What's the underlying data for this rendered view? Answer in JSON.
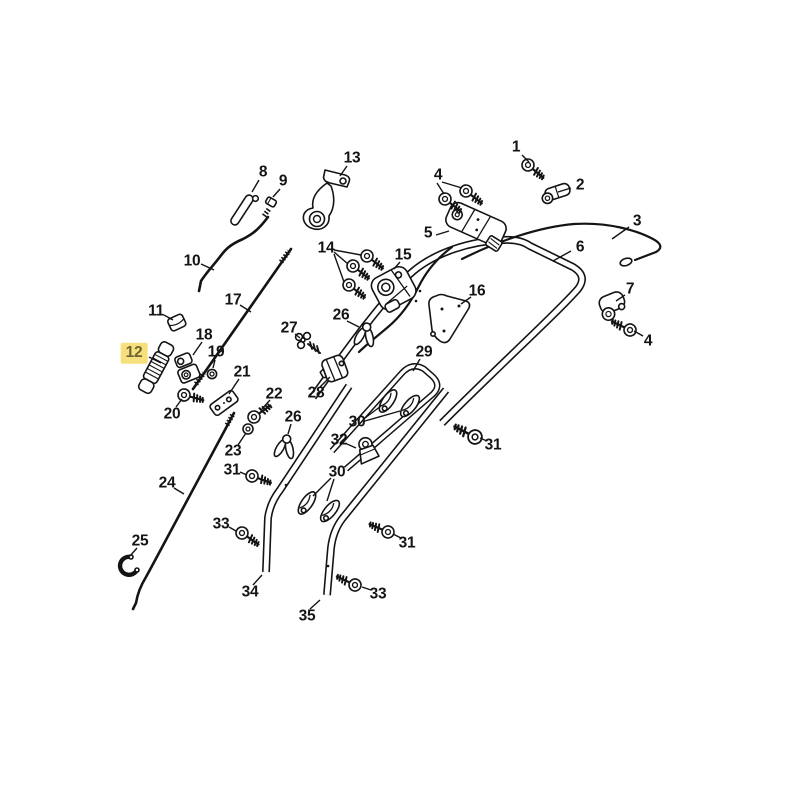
{
  "diagram": {
    "title": "exploded-parts-diagram",
    "style": {
      "background": "#FFFFFF",
      "line_color": "#141414",
      "highlight_fill": "#F5E07D",
      "highlight_text": "#6F6430"
    },
    "highlighted_part": "12",
    "callouts": [
      {
        "label": "1",
        "x": 516,
        "y": 147,
        "highlighted": false,
        "leaders": [
          [
            522,
            155,
            529,
            162
          ]
        ]
      },
      {
        "label": "2",
        "x": 580,
        "y": 185,
        "highlighted": false,
        "leaders": [
          [
            571,
            188,
            558,
            192
          ]
        ]
      },
      {
        "label": "3",
        "x": 637,
        "y": 221,
        "highlighted": false,
        "leaders": [
          [
            629,
            227,
            612,
            239
          ]
        ]
      },
      {
        "label": "4",
        "x": 438,
        "y": 175,
        "highlighted": false,
        "leaders": [
          [
            437,
            183,
            444,
            194
          ],
          [
            442,
            182,
            462,
            188
          ]
        ]
      },
      {
        "label": "5",
        "x": 428,
        "y": 233,
        "highlighted": false,
        "leaders": [
          [
            436,
            235,
            449,
            231
          ]
        ]
      },
      {
        "label": "6",
        "x": 580,
        "y": 247,
        "highlighted": false,
        "leaders": [
          [
            571,
            251,
            553,
            261
          ]
        ]
      },
      {
        "label": "7",
        "x": 630,
        "y": 289,
        "highlighted": false,
        "leaders": [
          [
            625,
            295,
            616,
            301
          ]
        ]
      },
      {
        "label": "4",
        "x": 648,
        "y": 341,
        "highlighted": false,
        "leaders": [
          [
            643,
            336,
            634,
            331
          ]
        ]
      },
      {
        "label": "8",
        "x": 263,
        "y": 172,
        "highlighted": false,
        "leaders": [
          [
            259,
            180,
            252,
            192
          ]
        ]
      },
      {
        "label": "9",
        "x": 283,
        "y": 181,
        "highlighted": false,
        "leaders": [
          [
            280,
            189,
            273,
            197
          ]
        ]
      },
      {
        "label": "10",
        "x": 192,
        "y": 261,
        "highlighted": false,
        "leaders": [
          [
            201,
            264,
            214,
            270
          ]
        ]
      },
      {
        "label": "11",
        "x": 156,
        "y": 311,
        "highlighted": false,
        "leaders": [
          [
            164,
            315,
            173,
            320
          ]
        ]
      },
      {
        "label": "12",
        "x": 134,
        "y": 353,
        "highlighted": true,
        "leaders": [
          [
            149,
            357,
            161,
            363
          ]
        ]
      },
      {
        "label": "13",
        "x": 352,
        "y": 158,
        "highlighted": false,
        "leaders": [
          [
            347,
            166,
            340,
            176
          ]
        ]
      },
      {
        "label": "14",
        "x": 326,
        "y": 248,
        "highlighted": false,
        "leaders": [
          [
            334,
            250,
            361,
            255
          ],
          [
            334,
            252,
            348,
            264
          ],
          [
            334,
            254,
            344,
            282
          ]
        ]
      },
      {
        "label": "15",
        "x": 403,
        "y": 255,
        "highlighted": false,
        "leaders": [
          [
            400,
            262,
            394,
            269
          ]
        ]
      },
      {
        "label": "16",
        "x": 477,
        "y": 291,
        "highlighted": false,
        "leaders": [
          [
            471,
            297,
            461,
            304
          ]
        ]
      },
      {
        "label": "17",
        "x": 233,
        "y": 300,
        "highlighted": false,
        "leaders": [
          [
            240,
            305,
            251,
            312
          ]
        ]
      },
      {
        "label": "18",
        "x": 204,
        "y": 335,
        "highlighted": false,
        "leaders": [
          [
            202,
            342,
            193,
            355
          ]
        ]
      },
      {
        "label": "19",
        "x": 216,
        "y": 352,
        "highlighted": false,
        "leaders": [
          [
            215,
            360,
            213,
            368
          ]
        ]
      },
      {
        "label": "20",
        "x": 172,
        "y": 414,
        "highlighted": false,
        "leaders": [
          [
            176,
            407,
            182,
            399
          ]
        ]
      },
      {
        "label": "21",
        "x": 242,
        "y": 372,
        "highlighted": false,
        "leaders": [
          [
            239,
            379,
            229,
            394
          ]
        ]
      },
      {
        "label": "22",
        "x": 274,
        "y": 394,
        "highlighted": false,
        "leaders": [
          [
            270,
            400,
            262,
            409
          ]
        ]
      },
      {
        "label": "23",
        "x": 233,
        "y": 451,
        "highlighted": false,
        "leaders": [
          [
            238,
            445,
            246,
            433
          ]
        ]
      },
      {
        "label": "24",
        "x": 167,
        "y": 483,
        "highlighted": false,
        "leaders": [
          [
            174,
            488,
            184,
            494
          ]
        ]
      },
      {
        "label": "25",
        "x": 140,
        "y": 541,
        "highlighted": false,
        "leaders": [
          [
            137,
            548,
            130,
            556
          ]
        ]
      },
      {
        "label": "26",
        "x": 341,
        "y": 315,
        "highlighted": false,
        "leaders": [
          [
            347,
            321,
            359,
            327
          ]
        ]
      },
      {
        "label": "27",
        "x": 289,
        "y": 328,
        "highlighted": false,
        "leaders": [
          [
            295,
            334,
            300,
            338
          ]
        ]
      },
      {
        "label": "28",
        "x": 316,
        "y": 393,
        "highlighted": false,
        "leaders": [
          [
            320,
            387,
            330,
            377
          ]
        ]
      },
      {
        "label": "29",
        "x": 424,
        "y": 352,
        "highlighted": false,
        "leaders": [
          [
            420,
            359,
            413,
            371
          ]
        ]
      },
      {
        "label": "30",
        "x": 357,
        "y": 422,
        "highlighted": false,
        "leaders": [
          [
            365,
            418,
            381,
            406
          ],
          [
            365,
            421,
            400,
            411
          ]
        ]
      },
      {
        "label": "26",
        "x": 293,
        "y": 417,
        "highlighted": false,
        "leaders": [
          [
            291,
            424,
            288,
            434
          ]
        ]
      },
      {
        "label": "32",
        "x": 339,
        "y": 440,
        "highlighted": false,
        "leaders": [
          [
            347,
            444,
            356,
            448
          ]
        ]
      },
      {
        "label": "30",
        "x": 337,
        "y": 472,
        "highlighted": false,
        "leaders": [
          [
            331,
            478,
            313,
            496
          ],
          [
            334,
            479,
            327,
            501
          ]
        ]
      },
      {
        "label": "31",
        "x": 232,
        "y": 470,
        "highlighted": false,
        "leaders": [
          [
            240,
            472,
            247,
            475
          ]
        ]
      },
      {
        "label": "31",
        "x": 493,
        "y": 445,
        "highlighted": false,
        "leaders": [
          [
            487,
            441,
            480,
            438
          ]
        ]
      },
      {
        "label": "31",
        "x": 407,
        "y": 543,
        "highlighted": false,
        "leaders": [
          [
            401,
            538,
            393,
            534
          ]
        ]
      },
      {
        "label": "33",
        "x": 221,
        "y": 524,
        "highlighted": false,
        "leaders": [
          [
            229,
            527,
            236,
            531
          ]
        ]
      },
      {
        "label": "33",
        "x": 378,
        "y": 594,
        "highlighted": false,
        "leaders": [
          [
            371,
            590,
            362,
            587
          ]
        ]
      },
      {
        "label": "34",
        "x": 250,
        "y": 592,
        "highlighted": false,
        "leaders": [
          [
            253,
            585,
            262,
            575
          ]
        ]
      },
      {
        "label": "35",
        "x": 307,
        "y": 616,
        "highlighted": false,
        "leaders": [
          [
            310,
            609,
            320,
            600
          ]
        ]
      }
    ]
  }
}
